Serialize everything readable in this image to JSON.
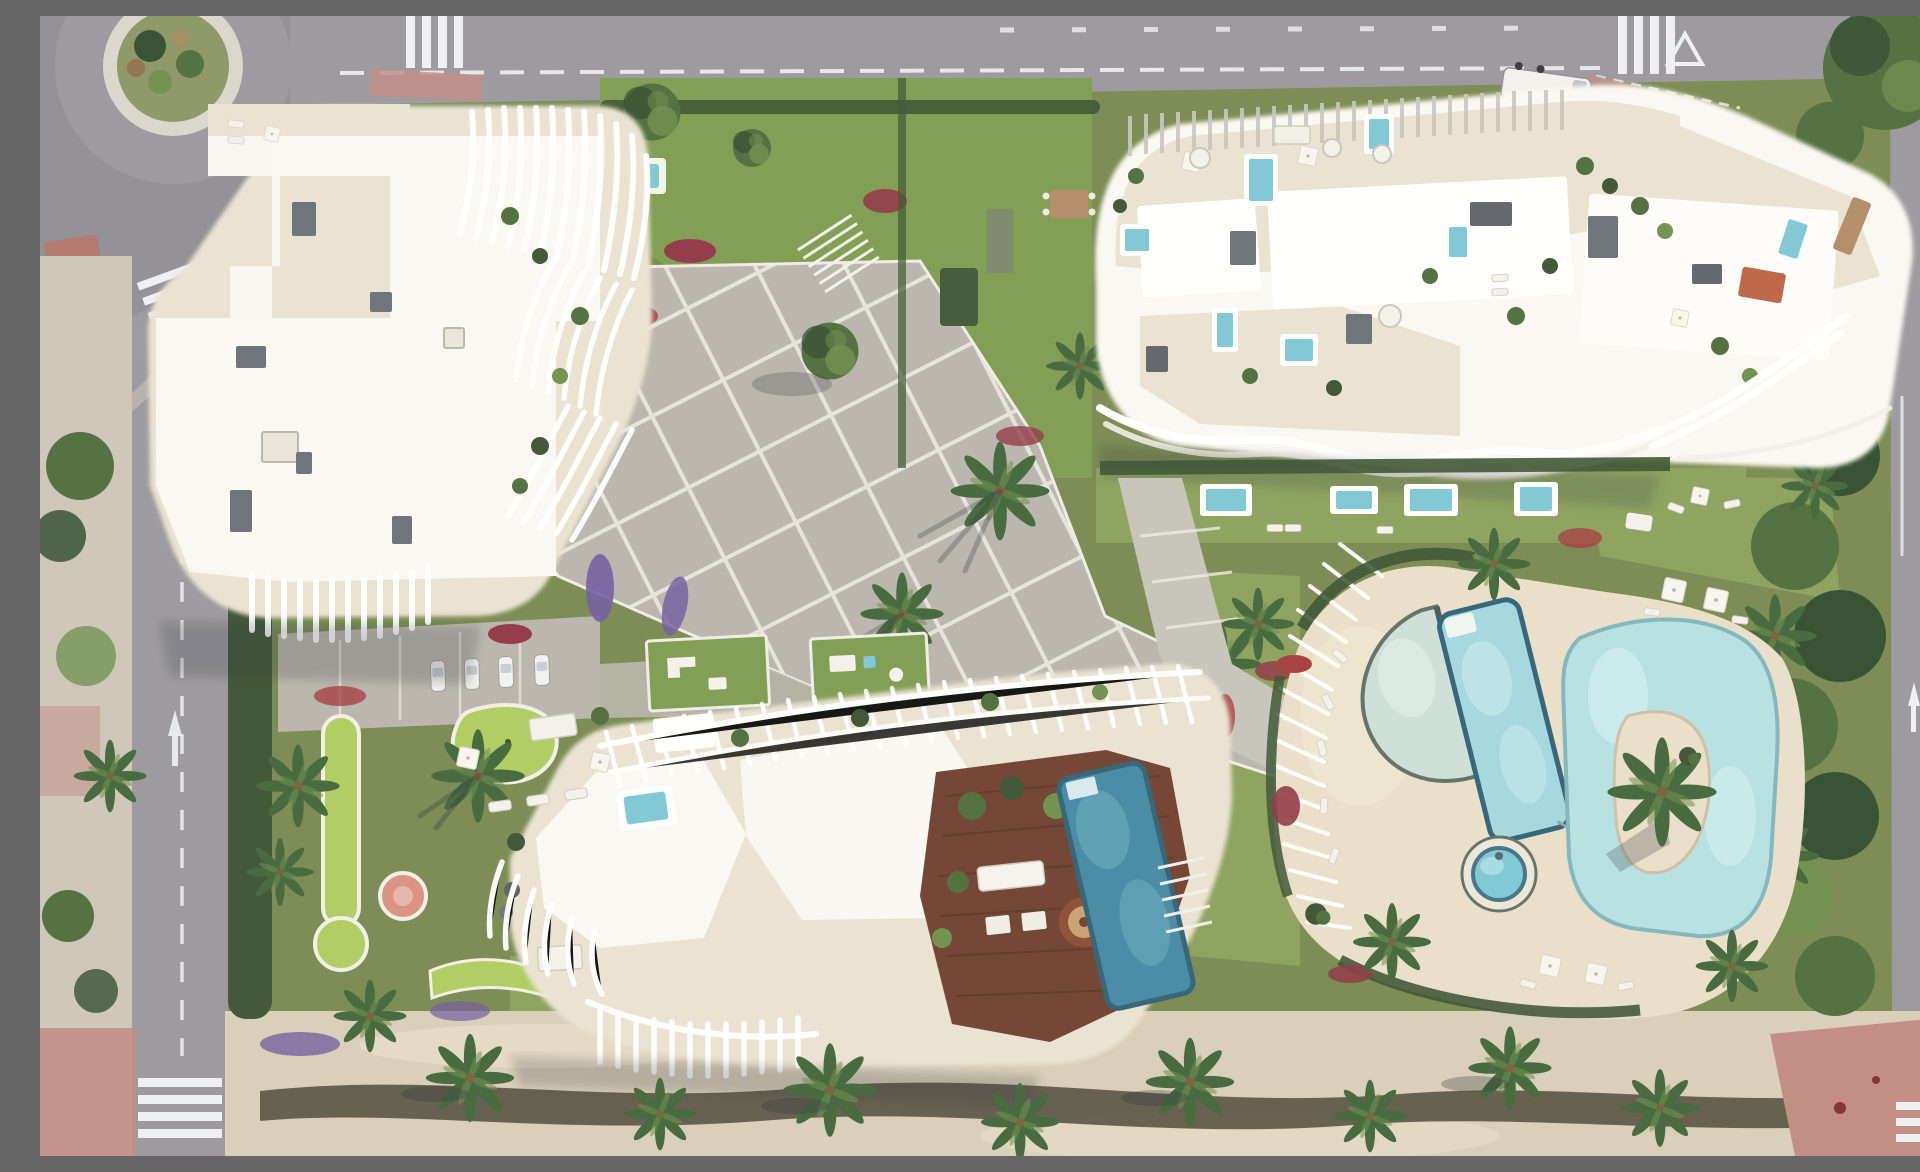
{
  "meta": {
    "description": "Aerial top-down architectural render of a Mediterranean residential complex with three white apartment buildings, rooftop terraces with plunge pools, a central paved plaza, landscaped gardens, a lagoon pool deck and perimeter roads",
    "time_of_day": "daylight",
    "view": "top-down aerial"
  },
  "palette": {
    "asphalt": "#98969b",
    "asphalt-dark": "#85848a",
    "road-line": "#eef0f2",
    "sidewalk-pink": "#c08a80",
    "sidewalk-beige": "#cdc5b8",
    "paving": "#b8b4ab",
    "paving-light": "#c6c2b9",
    "paving-line": "#eeebe4",
    "grass": "#76874d",
    "grass-light": "#8aa05a",
    "lawn-bright": "#7d9a4e",
    "golf-lime": "#aecb5c",
    "hedge-dark": "#3a5130",
    "tree-dark": "#2f4a2c",
    "tree-mid": "#4c6b3a",
    "tree-light": "#6d8d4a",
    "palm": "#3f6436",
    "flower-red": "#8e3442",
    "flower-crimson": "#a43a3c",
    "flower-purple": "#6f5a9e",
    "roof-white": "#faf8f3",
    "terrace-cream": "#e9e2d1",
    "fin-white": "#ffffff",
    "fin-shadow": "#c9c5bd",
    "ac-grey": "#696e75",
    "wood-deck": "#6e3e2d",
    "wood-tan": "#b08a63",
    "pool-blue": "#7cc6d4",
    "pool-deep": "#4287a3",
    "pool-pale": "#ccdfd6",
    "lagoon": "#b5e0e2",
    "pool-rim": "#2e5f74",
    "sand-deck": "#ead[f]c8",
    "sand": "#e9dec7",
    "sand-path": "#d8cdb6",
    "shadow": "#2a2f3a"
  },
  "scene": {
    "regions": {
      "top-road": "Main road along the top edge with lane markings and zebra crossings",
      "roundabout": "Roundabout with planted centre island, top-left corner",
      "left-road": "Secondary road along the left edge with crossing and arrow markings",
      "right-road": "Avenue along the right edge with turn arrows and crossing",
      "building-a": "North-west apartment building with curved white fin balconies",
      "building-b": "North-east apartment building with rooftop terraces and plunge pools",
      "building-c": "South apartment building with pergolas, wooden deck and rooftop pool",
      "central-plaza": "Central paved plaza with grid joints, palms and stairs",
      "mini-golf-garden": "West garden with putting-green shapes and play areas",
      "pool-deck": "Sand-coloured lagoon pool deck with pergola ribs",
      "lagoon-pool": "Organic lagoon pool with sandy palm island",
      "lap-pool": "Rectangular lap pool",
      "beach-pool": "Half-moon beach-entry pool",
      "kids-pool": "Small round children's pool",
      "rooftop-pool": "Dark rooftop pool on south building deck",
      "wooden-deck": "Rooftop timber deck with dining set and daybed",
      "beach-promenade": "Sandy promenade with palm trees along the bottom edge",
      "parking-area": "Drop-off lane with parked cars",
      "van": "White delivery van parked at the top-right junction",
      "gardens": "Landscaped gardens with red, crimson and purple flower beds"
    }
  }
}
